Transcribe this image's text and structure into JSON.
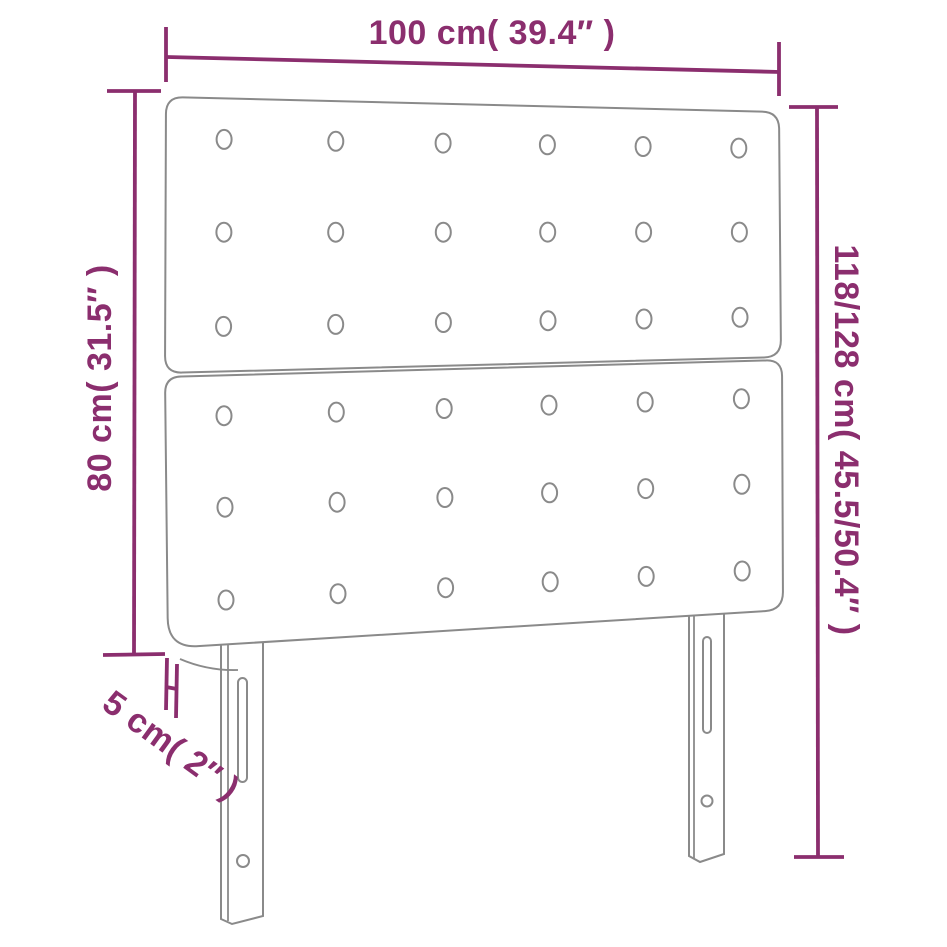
{
  "page": {
    "background_color": "#ffffff"
  },
  "diagram": {
    "kind": "furniture-dimension-diagram",
    "subject": "tufted headboard with two stacked panels and two slotted legs",
    "accent_color": "#8b2e6e",
    "outline_color": "#8a8a8a",
    "labels": {
      "width": "100 cm( 39.4″ )",
      "height_left": "80 cm( 31.5″ )",
      "height_right": "118/128 cm( 45.5/50.4″ )",
      "thickness": "5 cm( 2″ )"
    },
    "button_grid": {
      "panels": 2,
      "rows_per_panel": 3,
      "columns": 6
    }
  }
}
